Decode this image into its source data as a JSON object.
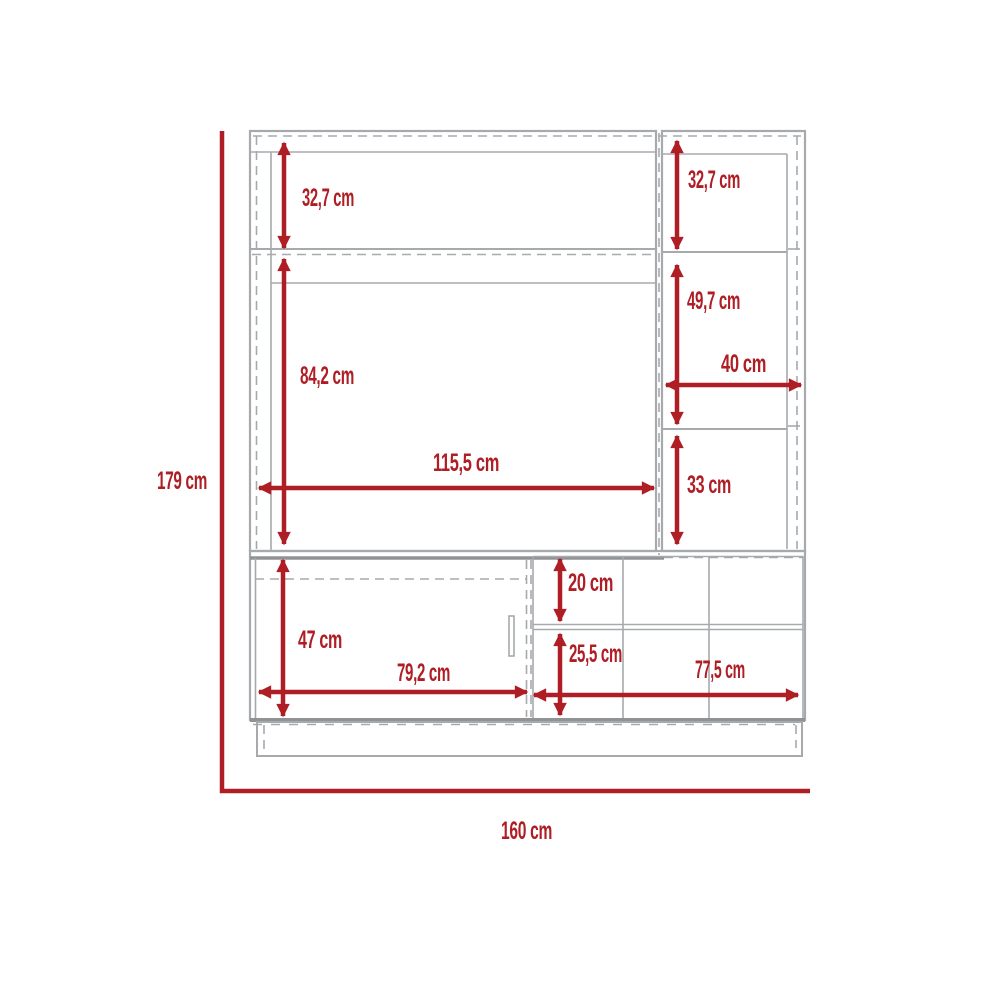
{
  "diagram": {
    "type": "furniture-dimension-drawing",
    "unit": "cm",
    "colors": {
      "dimension": "#AE1E24",
      "outline": "#A7AAAD",
      "outline-dark": "#909396",
      "background": "#FFFFFF"
    },
    "overall": {
      "height": "179 cm",
      "width": "160 cm"
    },
    "labels": {
      "upper_left_shelf_height": "32,7 cm",
      "upper_right_shelf_height": "32,7 cm",
      "right_middle_shelf_height": "49,7 cm",
      "right_section_width": "40 cm",
      "tv_opening_height": "84,2 cm",
      "tv_opening_width": "115,5 cm",
      "right_lower_shelf_height": "33 cm",
      "top_drawer_height": "20 cm",
      "door_height": "47 cm",
      "bottom_drawer_height": "25,5 cm",
      "door_width": "79,2 cm",
      "drawer_section_width": "77,5 cm",
      "total_height": "179 cm",
      "total_width": "160 cm"
    }
  }
}
